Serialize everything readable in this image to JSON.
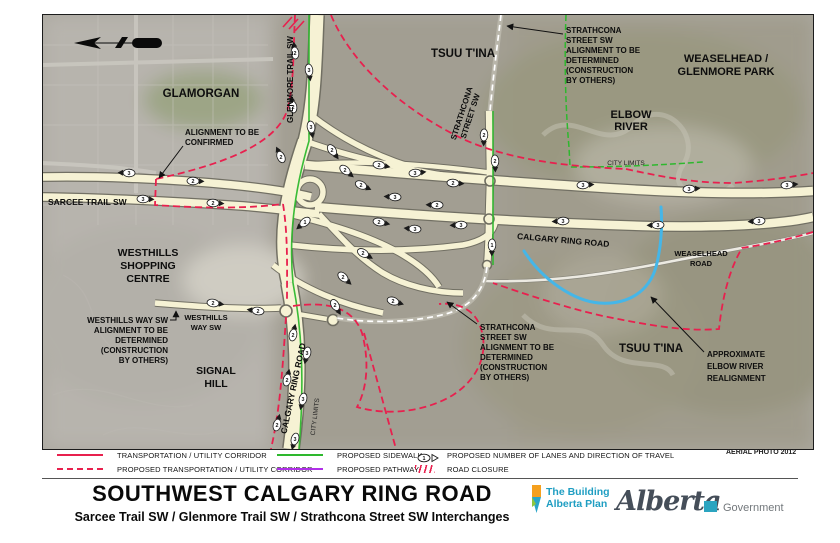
{
  "page": {
    "title": "SOUTHWEST CALGARY RING ROAD",
    "subtitle": "Sarcee Trail SW / Glenmore Trail SW / Strathcona Street SW Interchanges",
    "aerial_credit": "AERIAL PHOTO 2012"
  },
  "colors": {
    "corridor_red": "#e8204e",
    "sidewalk_green": "#2eb82e",
    "pathway_purple": "#b030e8",
    "river_blue": "#45b6e8",
    "road_fill": "#f6f2d4",
    "road_casing": "#6f6d61",
    "logo_teal": "#1f9ec2"
  },
  "legend": {
    "tuc": "TRANSPORTATION / UTILITY CORRIDOR",
    "proposed_tuc": "PROPOSED TRANSPORTATION / UTILITY CORRIDOR",
    "sidewalk": "PROPOSED SIDEWALK",
    "pathway": "PROPOSED PATHWAY",
    "lanes": "PROPOSED NUMBER OF LANES AND DIRECTION OF TRAVEL",
    "closure": "ROAD CLOSURE",
    "lane_symbol_number": "1"
  },
  "footer": {
    "building_alberta_line1": "The Building",
    "building_alberta_line2": "Alberta Plan",
    "alberta_script": "Alberta",
    "government": "Government"
  },
  "map": {
    "labels": {
      "glamorgan": "GLAMORGAN",
      "tsuu_tina_north": "TSUU T'INA",
      "tsuu_tina_south": "TSUU T'INA",
      "weaselhead_park_1": "WEASELHEAD /",
      "weaselhead_park_2": "GLENMORE PARK",
      "elbow_river_1": "ELBOW",
      "elbow_river_2": "RIVER",
      "glenmore_trail": "GLENMORE TRAIL SW",
      "strathcona_street_1": "STRATHCONA",
      "strathcona_street_2": "STREET SW",
      "sarcee_trail": "SARCEE TRAIL  SW",
      "calgary_ring_road_east": "CALGARY RING ROAD",
      "calgary_ring_road_south": "CALGARY RING ROAD",
      "weaselhead_road_1": "WEASELHEAD",
      "weaselhead_road_2": "ROAD",
      "westhills_shopping_1": "WESTHILLS",
      "westhills_shopping_2": "SHOPPING",
      "westhills_shopping_3": "CENTRE",
      "signal_hill_1": "SIGNAL",
      "signal_hill_2": "HILL",
      "westhills_way_1": "WESTHILLS",
      "westhills_way_2": "WAY SW",
      "city_limits_east": "CITY LIMITS",
      "city_limits_south": "CITY LIMITS"
    },
    "annotations": {
      "alignment_confirmed_1": "ALIGNMENT TO BE",
      "alignment_confirmed_2": "CONFIRMED",
      "strathcona_note_1": "STRATHCONA",
      "strathcona_note_2": "STREET SW",
      "strathcona_note_3": "ALIGNMENT TO BE",
      "strathcona_note_4": "DETERMINED",
      "strathcona_note_5": "(CONSTRUCTION",
      "strathcona_note_6": "BY OTHERS)",
      "westhills_note_1": "WESTHILLS WAY SW",
      "westhills_note_2": "ALIGNMENT TO BE",
      "westhills_note_3": "DETERMINED",
      "westhills_note_4": "(CONSTRUCTION",
      "westhills_note_5": "BY OTHERS)",
      "river_note_1": "APPROXIMATE",
      "river_note_2": "ELBOW RIVER",
      "river_note_3": "REALIGNMENT"
    },
    "lane_markers": [
      {
        "x": 252,
        "y": 38,
        "a": -97,
        "n": "2"
      },
      {
        "x": 266,
        "y": 55,
        "a": 83,
        "n": "3"
      },
      {
        "x": 250,
        "y": 92,
        "a": -99,
        "n": "2"
      },
      {
        "x": 268,
        "y": 112,
        "a": 81,
        "n": "3"
      },
      {
        "x": 238,
        "y": 142,
        "a": -115,
        "n": "2"
      },
      {
        "x": 289,
        "y": 135,
        "a": 55,
        "n": "2"
      },
      {
        "x": 302,
        "y": 155,
        "a": 40,
        "n": "2"
      },
      {
        "x": 318,
        "y": 170,
        "a": 25,
        "n": "2"
      },
      {
        "x": 262,
        "y": 207,
        "a": 140,
        "n": "1"
      },
      {
        "x": 86,
        "y": 158,
        "a": -178,
        "n": "3"
      },
      {
        "x": 150,
        "y": 166,
        "a": 2,
        "n": "2"
      },
      {
        "x": 100,
        "y": 184,
        "a": 2,
        "n": "3"
      },
      {
        "x": 170,
        "y": 188,
        "a": 3,
        "n": "2"
      },
      {
        "x": 336,
        "y": 150,
        "a": 10,
        "n": "2"
      },
      {
        "x": 372,
        "y": 158,
        "a": -6,
        "n": "3"
      },
      {
        "x": 410,
        "y": 168,
        "a": 4,
        "n": "2"
      },
      {
        "x": 352,
        "y": 182,
        "a": 183,
        "n": "3"
      },
      {
        "x": 394,
        "y": 190,
        "a": 181,
        "n": "2"
      },
      {
        "x": 336,
        "y": 207,
        "a": 12,
        "n": "2"
      },
      {
        "x": 372,
        "y": 214,
        "a": 185,
        "n": "3"
      },
      {
        "x": 418,
        "y": 210,
        "a": 178,
        "n": "3"
      },
      {
        "x": 540,
        "y": 170,
        "a": -3,
        "n": "3"
      },
      {
        "x": 646,
        "y": 174,
        "a": -4,
        "n": "3"
      },
      {
        "x": 744,
        "y": 170,
        "a": -5,
        "n": "3"
      },
      {
        "x": 520,
        "y": 206,
        "a": 177,
        "n": "3"
      },
      {
        "x": 615,
        "y": 210,
        "a": 178,
        "n": "3"
      },
      {
        "x": 716,
        "y": 206,
        "a": 176,
        "n": "3"
      },
      {
        "x": 441,
        "y": 120,
        "a": 92,
        "n": "2"
      },
      {
        "x": 452,
        "y": 146,
        "a": 88,
        "n": "2"
      },
      {
        "x": 449,
        "y": 230,
        "a": 91,
        "n": "1"
      },
      {
        "x": 320,
        "y": 238,
        "a": 30,
        "n": "2"
      },
      {
        "x": 300,
        "y": 262,
        "a": 42,
        "n": "2"
      },
      {
        "x": 350,
        "y": 286,
        "a": 18,
        "n": "2"
      },
      {
        "x": 250,
        "y": 320,
        "a": -78,
        "n": "2"
      },
      {
        "x": 264,
        "y": 338,
        "a": 102,
        "n": "3"
      },
      {
        "x": 244,
        "y": 365,
        "a": -78,
        "n": "2"
      },
      {
        "x": 260,
        "y": 384,
        "a": 104,
        "n": "3"
      },
      {
        "x": 234,
        "y": 410,
        "a": -76,
        "n": "2"
      },
      {
        "x": 252,
        "y": 424,
        "a": 106,
        "n": "3"
      },
      {
        "x": 170,
        "y": 288,
        "a": 8,
        "n": "2"
      },
      {
        "x": 215,
        "y": 296,
        "a": -172,
        "n": "2"
      },
      {
        "x": 292,
        "y": 290,
        "a": 60,
        "n": "2"
      }
    ]
  }
}
